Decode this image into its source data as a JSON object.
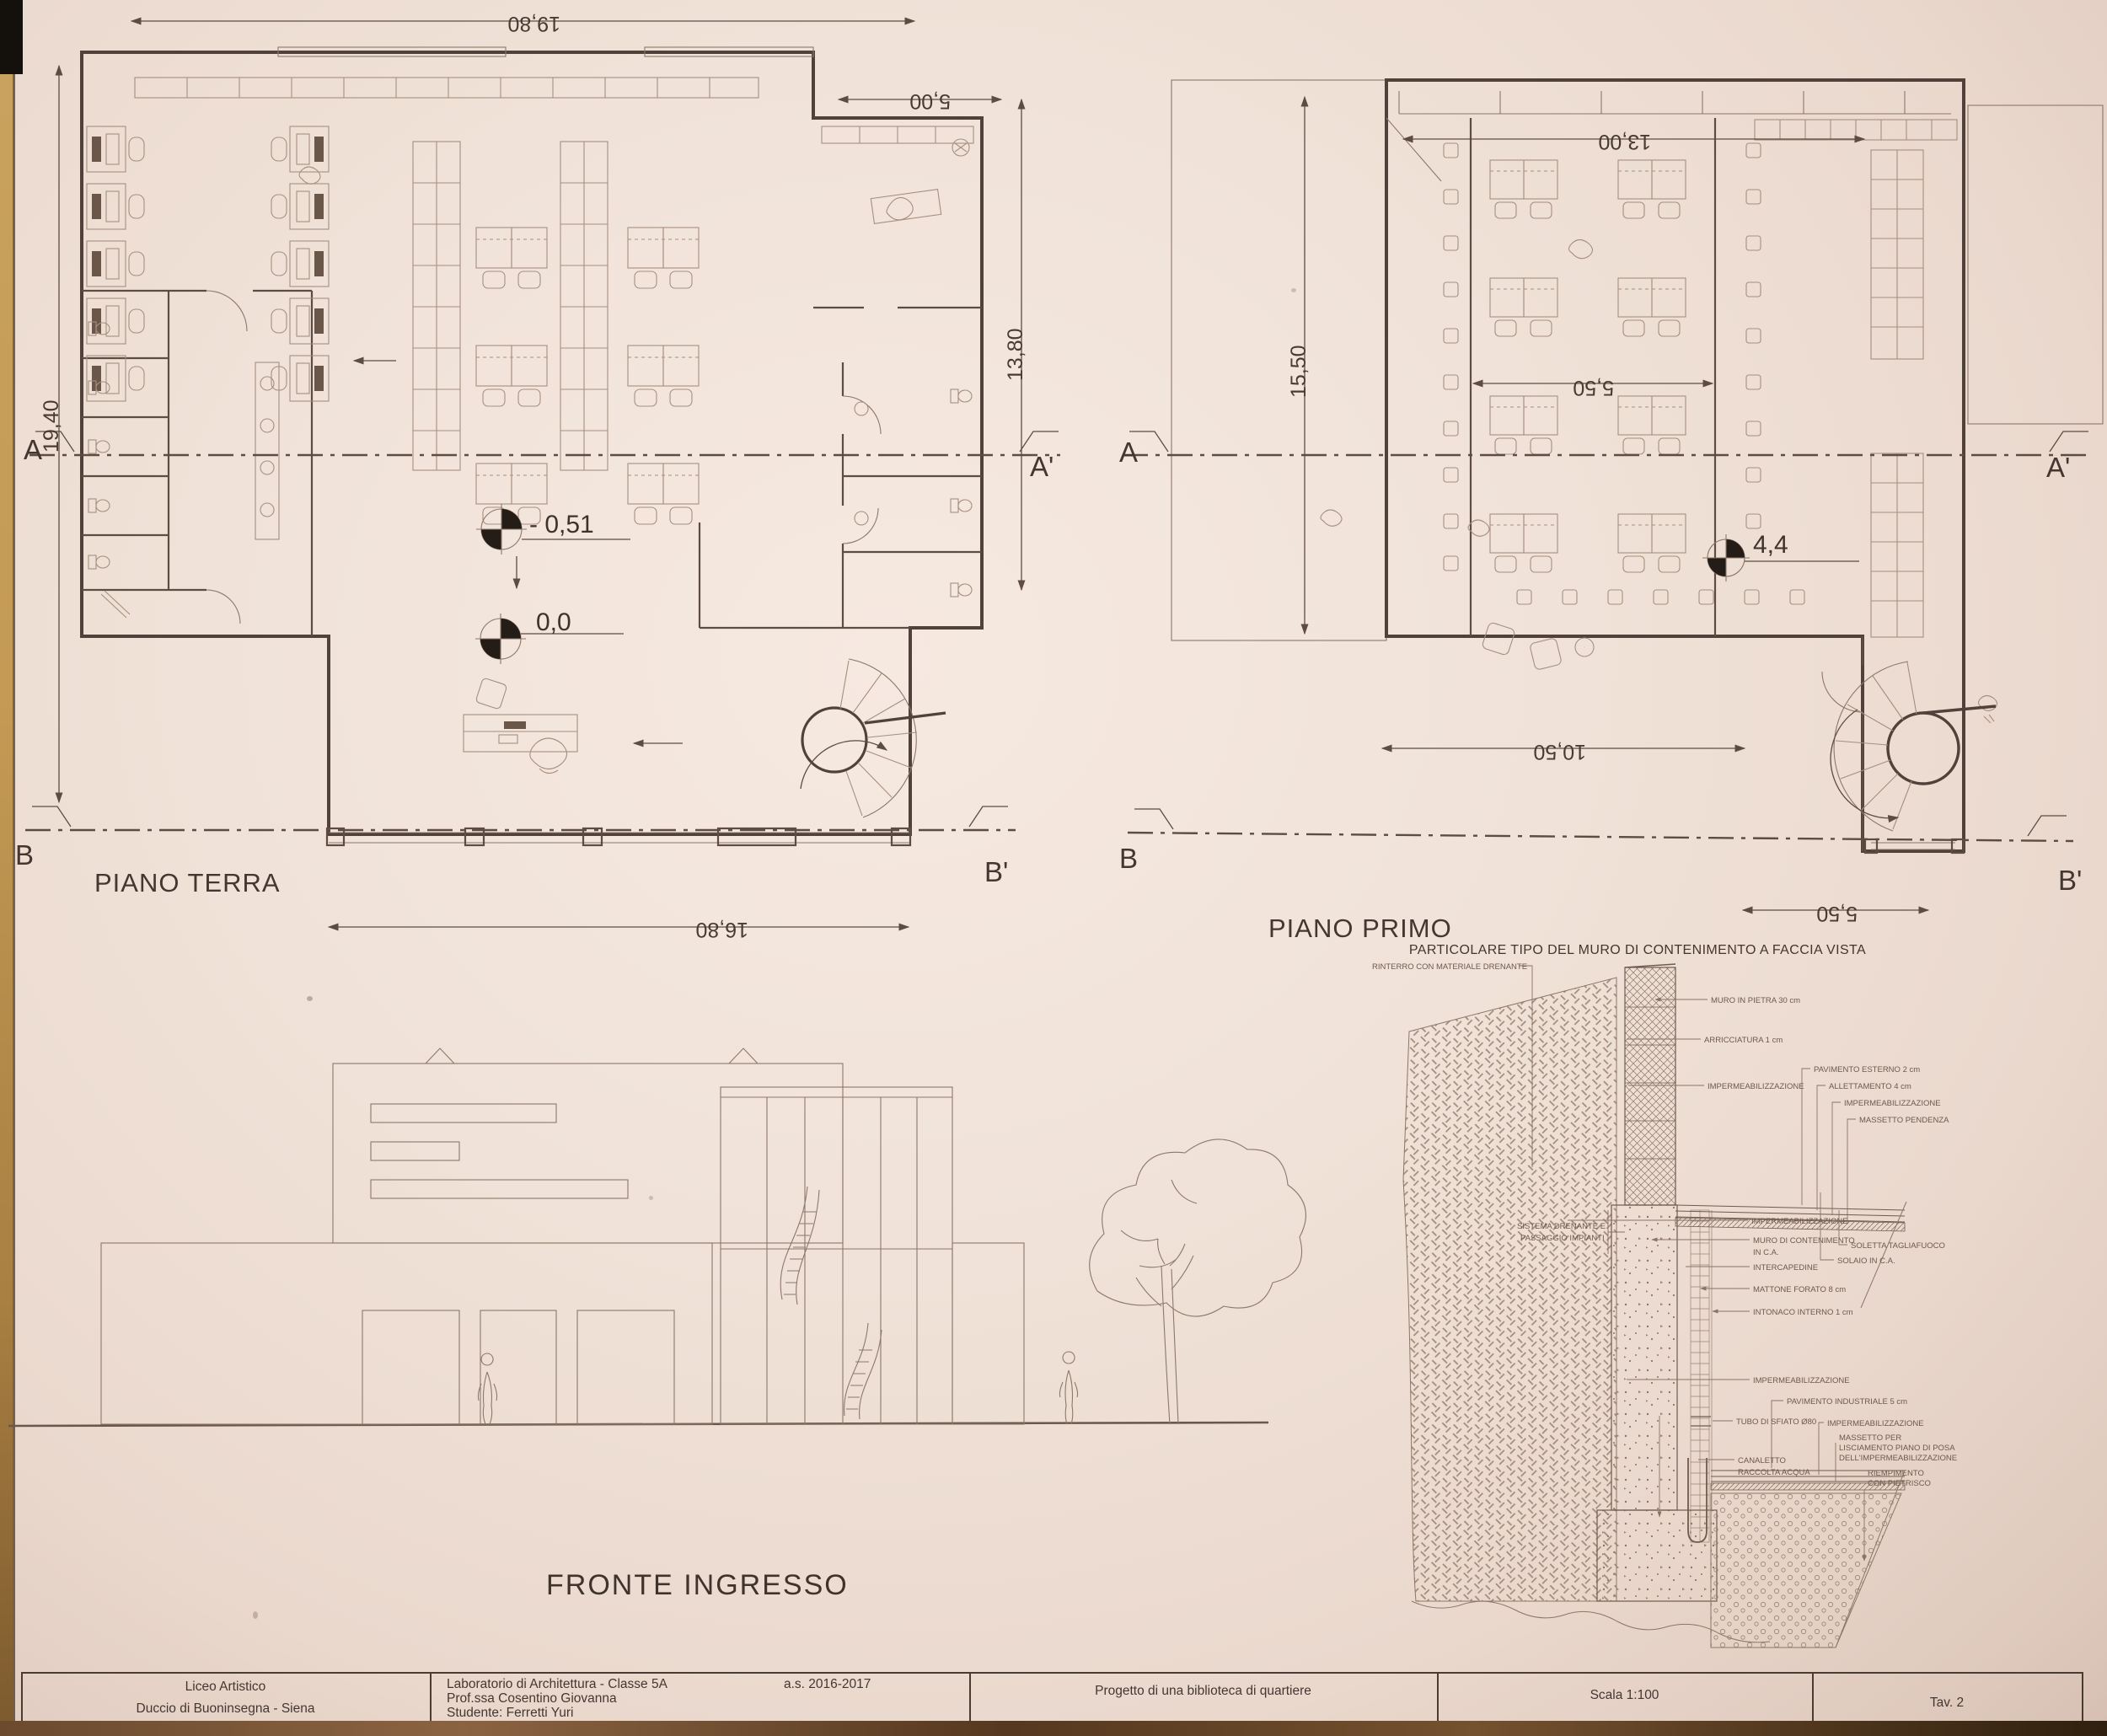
{
  "sheet": {
    "colors": {
      "paper": "#f0e2d8",
      "ink": "#4a3a33",
      "line": "#6b564b",
      "edge_tan": "#c49a55"
    },
    "plans": {
      "terra": {
        "title": "PIANO TERRA",
        "dim_top": "19,80",
        "dim_top_right": "5,00",
        "dim_left": "19,40",
        "dim_right": "13,80",
        "dim_bottom": "16,80",
        "level_inner": "- 0,51",
        "level_entry": "0,0",
        "sec_a": "A",
        "sec_a1": "A'",
        "sec_b": "B",
        "sec_b1": "B'"
      },
      "primo": {
        "title": "PIANO PRIMO",
        "dim_top": "13,00",
        "dim_left": "15,50",
        "dim_mid": "5,50",
        "dim_bottom": "10,50",
        "dim_stair": "5,50",
        "level": "4,4",
        "sec_a": "A",
        "sec_a1": "A'",
        "sec_b": "B",
        "sec_b1": "B'"
      }
    },
    "elevation": {
      "title": "FRONTE INGRESSO"
    },
    "detail": {
      "title": "PARTICOLARE TIPO DEL MURO DI CONTENIMENTO A FACCIA VISTA",
      "annotations": [
        [
          "RINTERRO CON MATERIALE DRENANTE"
        ],
        [
          "MURO IN PIETRA 30 cm"
        ],
        [
          "ARRICCIATURA 1 cm"
        ],
        [
          "IMPERMEABILIZZAZIONE"
        ],
        [
          "PAVIMENTO ESTERNO 2 cm"
        ],
        [
          "ALLETTAMENTO 4 cm"
        ],
        [
          "IMPERMEABILIZZAZIONE"
        ],
        [
          "MASSETTO PENDENZA"
        ],
        [
          "SISTEMA DRENANTE E",
          "PASSAGGIO IMPIANTI"
        ],
        [
          "IMPERMEABILIZZAZIONE"
        ],
        [
          "MURO DI CONTENIMENTO",
          "IN C.A."
        ],
        [
          "INTERCAPEDINE"
        ],
        [
          "MATTONE FORATO 8 cm"
        ],
        [
          "INTONACO INTERNO 1 cm"
        ],
        [
          "SOLETTA TAGLIAFUOCO"
        ],
        [
          "SOLAIO IN C.A."
        ],
        [
          "IMPERMEABILIZZAZIONE"
        ],
        [
          "TUBO DI SFIATO Ø80"
        ],
        [
          "CANALETTO",
          "RACCOLTA ACQUA"
        ],
        [
          "PAVIMENTO INDUSTRIALE 5 cm"
        ],
        [
          "IMPERMEABILIZZAZIONE"
        ],
        [
          "MASSETTO PER",
          "LISCIAMENTO PIANO DI POSA",
          "DELL'IMPERMEABILIZZAZIONE"
        ],
        [
          "RIEMPIMENTO",
          "CON PIETRISCO"
        ]
      ]
    },
    "titleblock": {
      "school_line1": "Liceo Artistico",
      "school_line2": "Duccio di Buoninsegna - Siena",
      "lab_line1": "Laboratorio di Architettura - Classe 5A",
      "lab_line2": "Prof.ssa Cosentino Giovanna",
      "lab_line3": "Studente: Ferretti Yuri",
      "year": "a.s. 2016-2017",
      "project": "Progetto di una biblioteca di quartiere",
      "scale": "Scala 1:100",
      "sheet_no": "Tav. 2"
    }
  }
}
